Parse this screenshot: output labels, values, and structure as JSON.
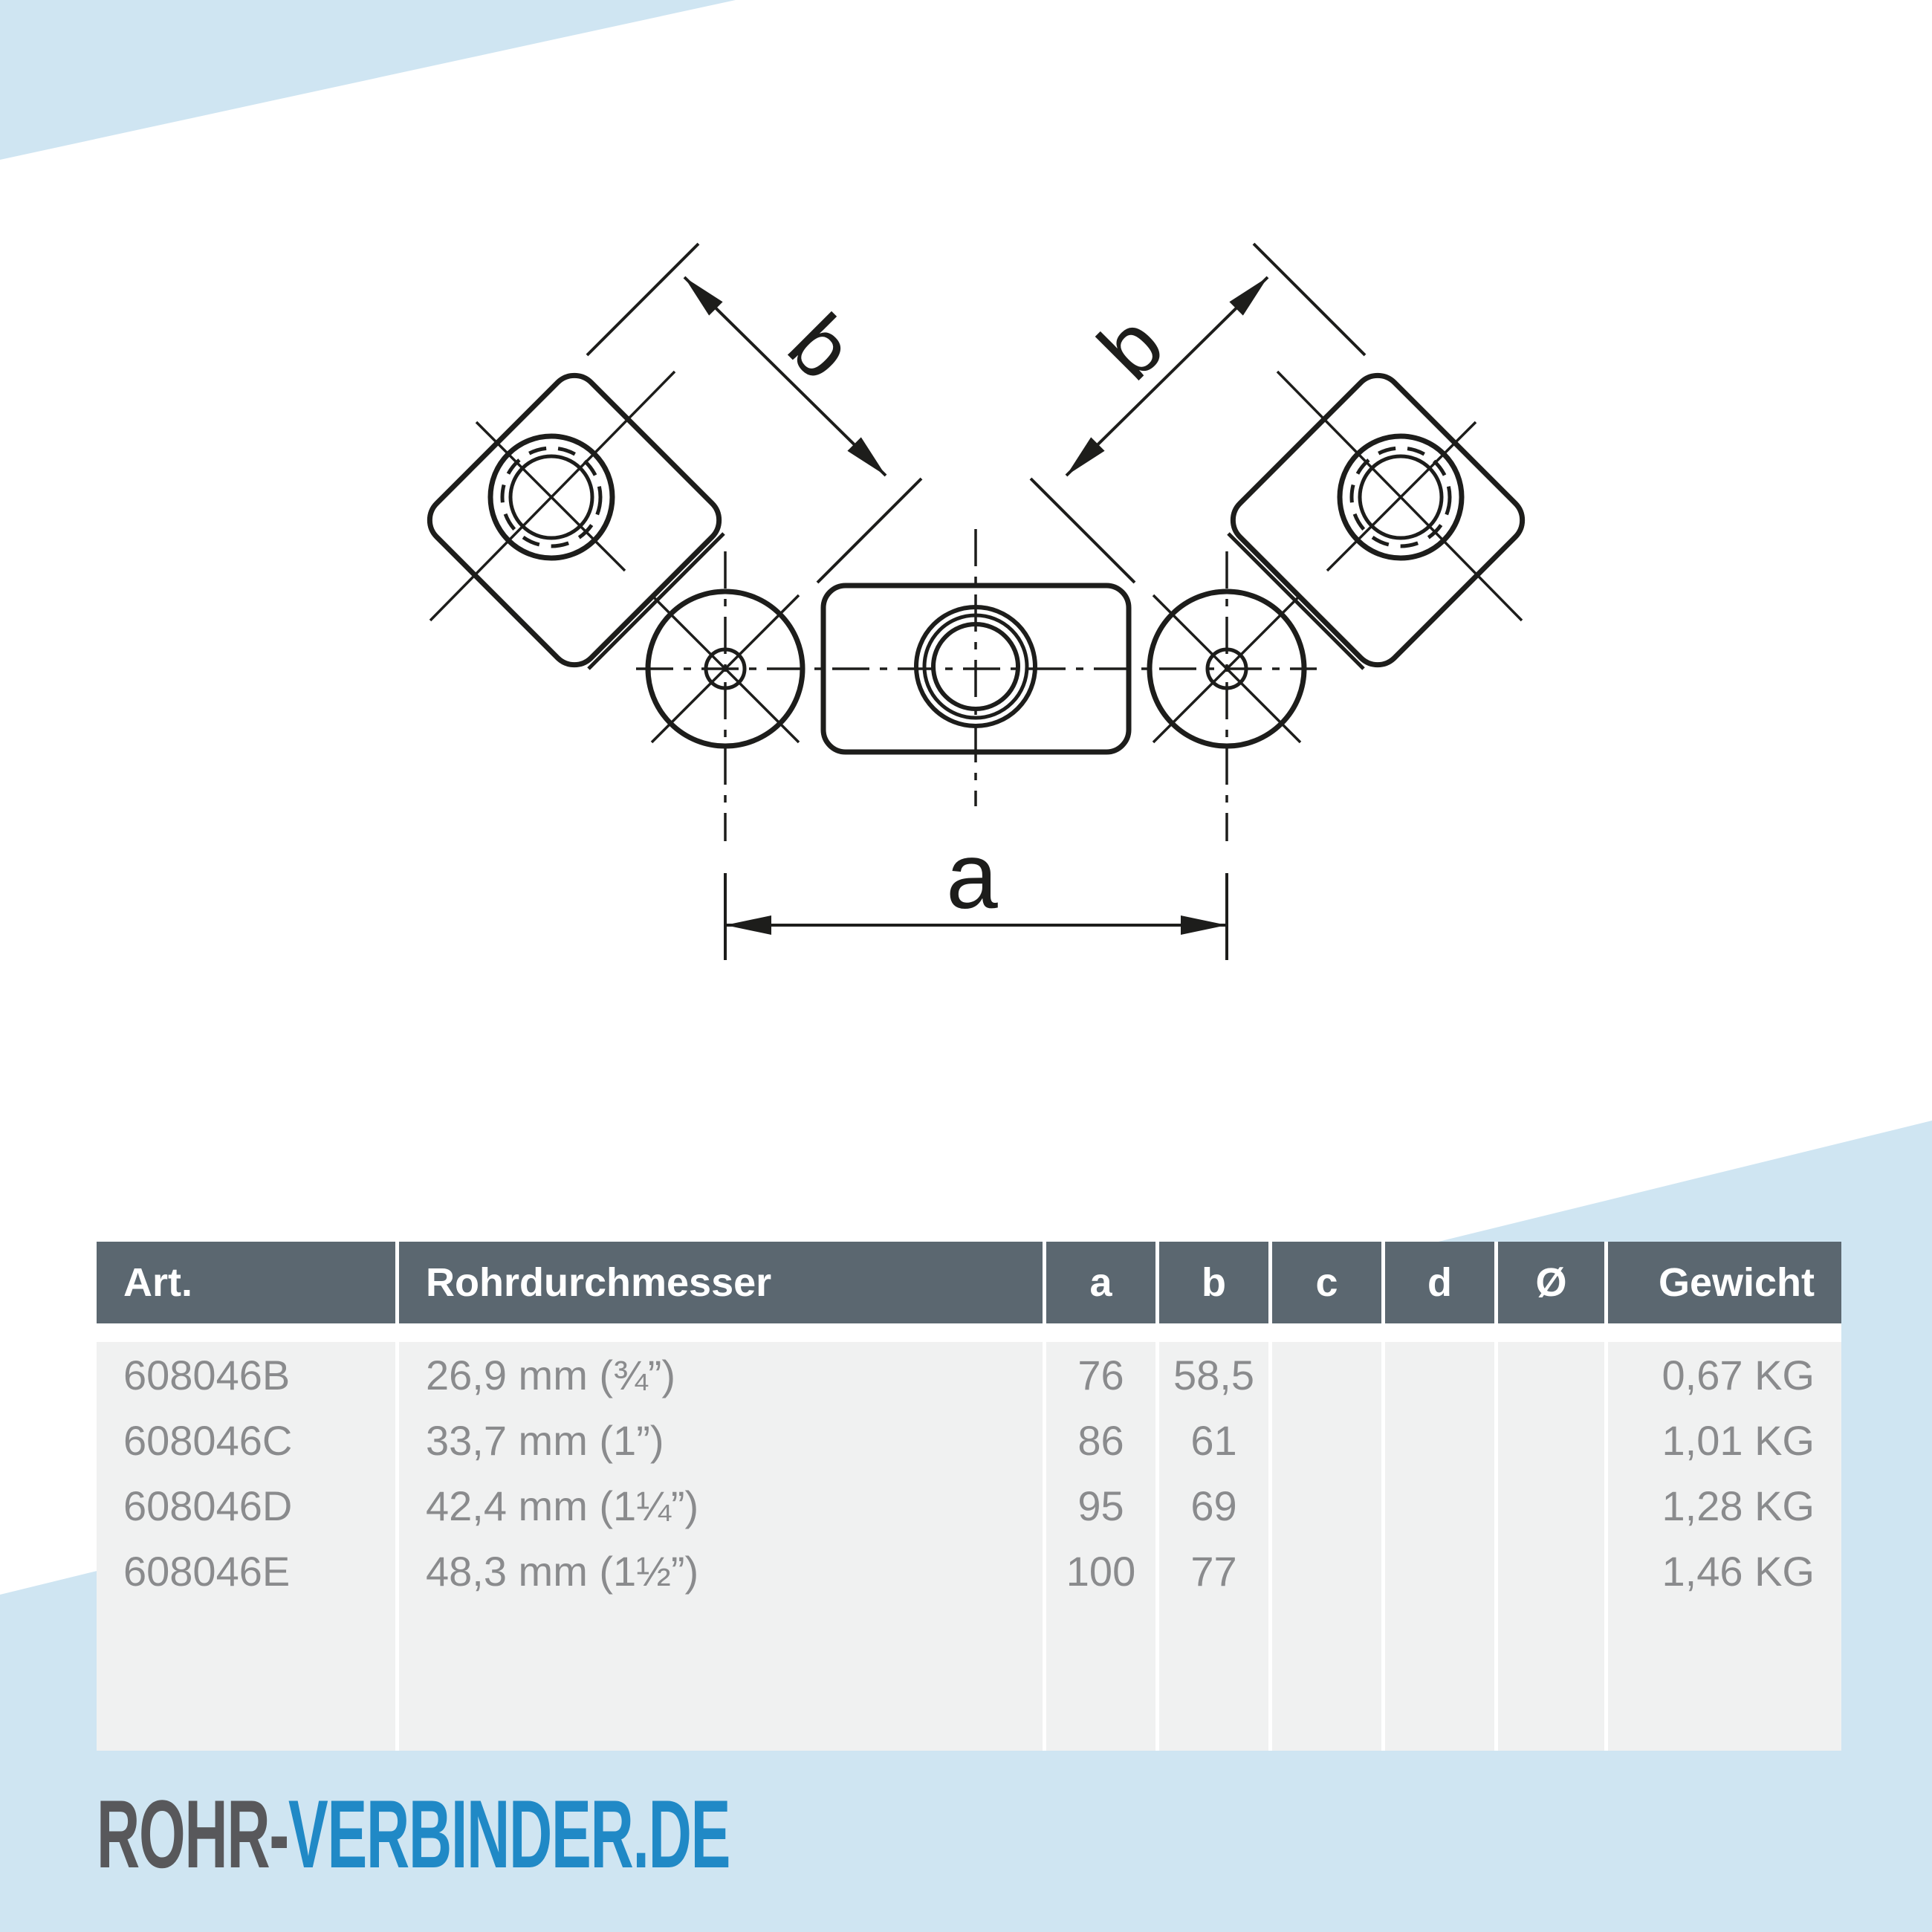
{
  "colors": {
    "accent_blue": "#cfe5f2",
    "table_header_bg": "#5b6770",
    "table_header_text": "#ffffff",
    "table_body_bg": "#f0f1f1",
    "table_body_text": "#8a8b8d",
    "drawing_line": "#1d1d1b",
    "logo_gray": "#58585b",
    "logo_blue": "#2089c6"
  },
  "drawing": {
    "label_a": "a",
    "label_b_left": "b",
    "label_b_right": "b"
  },
  "table": {
    "headers": [
      "Art.",
      "Rohrdurchmesser",
      "a",
      "b",
      "c",
      "d",
      "Ø",
      "Gewicht"
    ],
    "rows": [
      {
        "art": "608046B",
        "rohrdurchmesser": "26,9 mm (¾”)",
        "a": "76",
        "b": "58,5",
        "c": "",
        "d": "",
        "diameter": "",
        "gewicht": "0,67 KG"
      },
      {
        "art": "608046C",
        "rohrdurchmesser": "33,7 mm (1”)",
        "a": "86",
        "b": "61",
        "c": "",
        "d": "",
        "diameter": "",
        "gewicht": "1,01 KG"
      },
      {
        "art": "608046D",
        "rohrdurchmesser": "42,4 mm (1¼”)",
        "a": "95",
        "b": "69",
        "c": "",
        "d": "",
        "diameter": "",
        "gewicht": "1,28 KG"
      },
      {
        "art": "608046E",
        "rohrdurchmesser": "48,3 mm (1½”)",
        "a": "100",
        "b": "77",
        "c": "",
        "d": "",
        "diameter": "",
        "gewicht": "1,46 KG"
      }
    ]
  },
  "logo": {
    "prefix": "ROHR-",
    "suffix": "VERBINDER.DE"
  }
}
